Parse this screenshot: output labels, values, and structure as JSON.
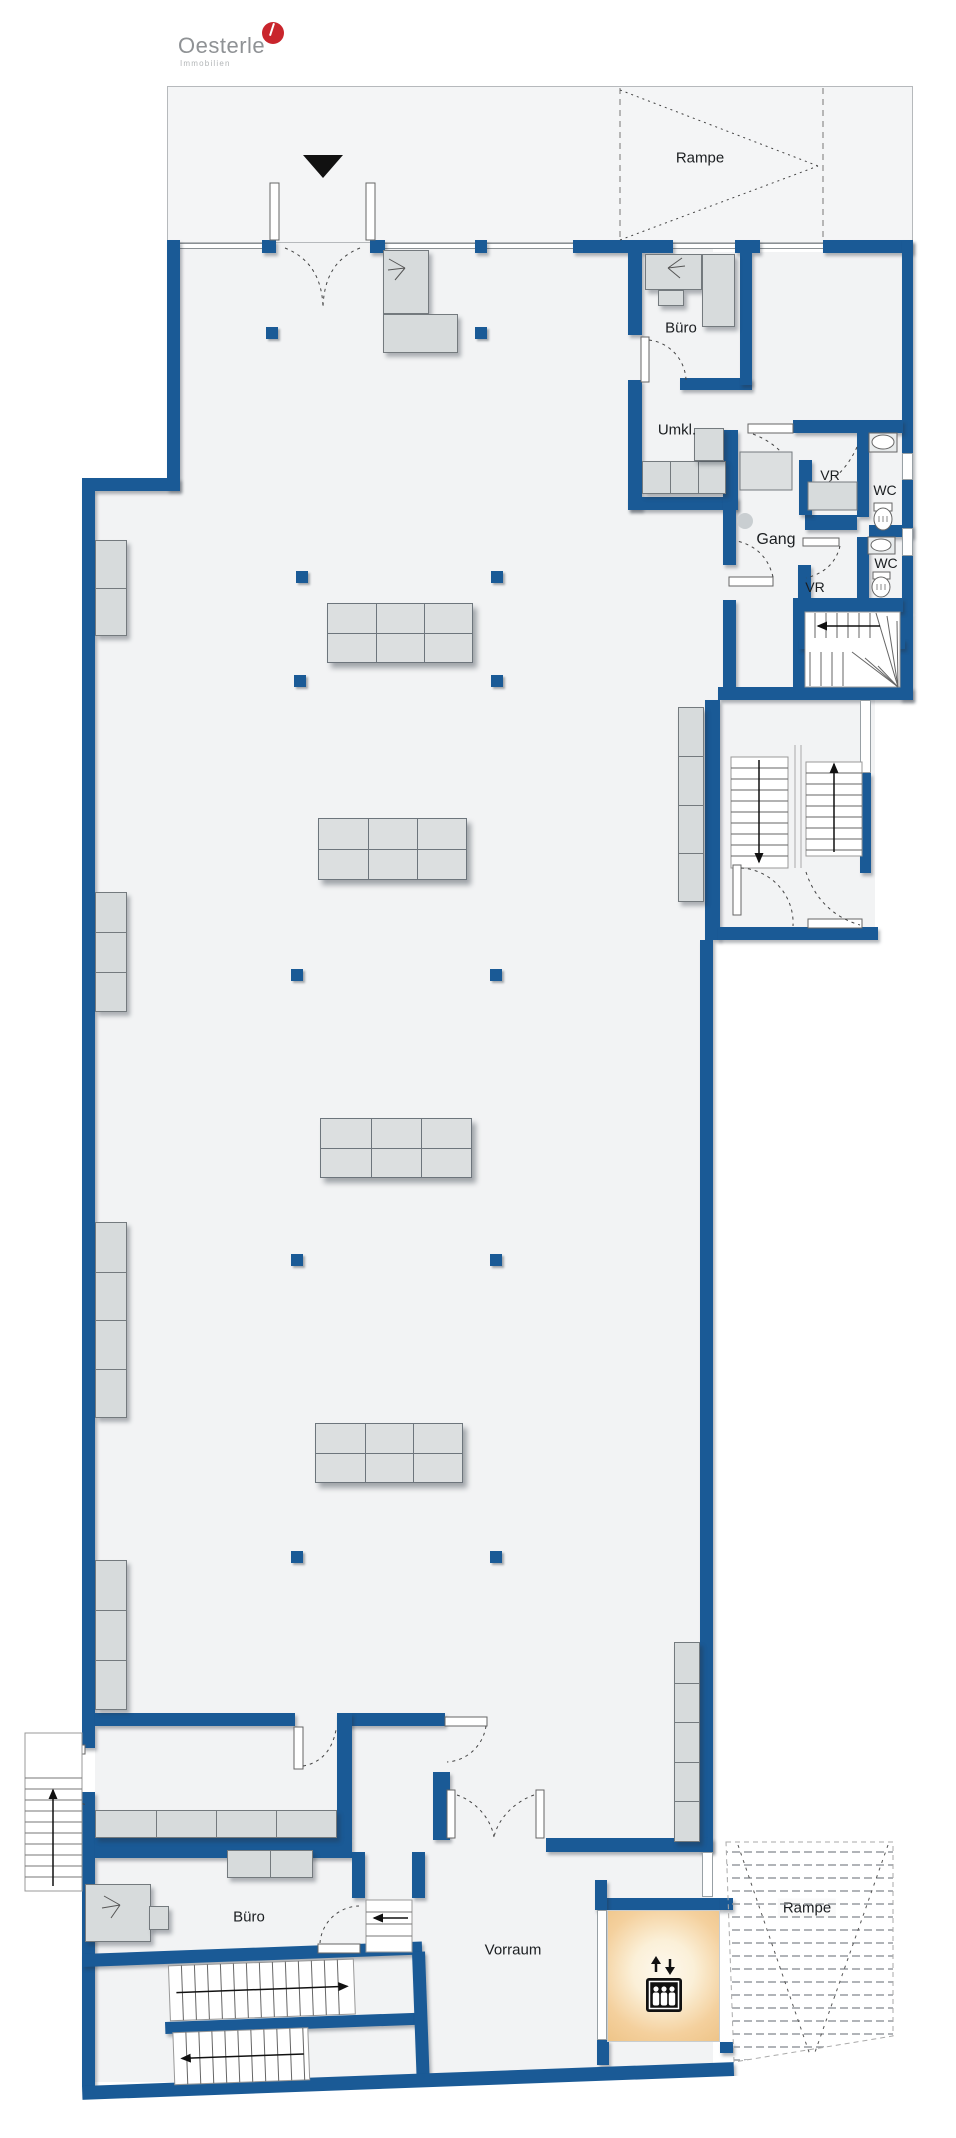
{
  "page": {
    "width": 956,
    "height": 2138,
    "background": "#ffffff"
  },
  "logo": {
    "brand": "Oesterle",
    "tagline": "Immobilien",
    "mark": "red-circle"
  },
  "plan": {
    "rooms": [
      {
        "id": "ramp_top",
        "label": "Rampe"
      },
      {
        "id": "buero_top",
        "label": "Büro"
      },
      {
        "id": "umkl",
        "label": "Umkl."
      },
      {
        "id": "vr_upper",
        "label": "VR"
      },
      {
        "id": "wc_upper",
        "label": "WC"
      },
      {
        "id": "gang",
        "label": "Gang"
      },
      {
        "id": "wc_lower",
        "label": "WC"
      },
      {
        "id": "vr_lower",
        "label": "VR"
      },
      {
        "id": "buero_bottom",
        "label": "Büro"
      },
      {
        "id": "vorraum",
        "label": "Vorraum"
      },
      {
        "id": "ramp_bottom",
        "label": "Rampe"
      }
    ],
    "colors": {
      "wall": "#1a5a96",
      "floor": "#f2f3f4",
      "furniture": "#d7dbdc",
      "elevator_highlight": "#eec488",
      "logo_red": "#c9252c"
    },
    "icons": [
      {
        "name": "entrance-arrow-icon",
        "meaning": "entrance direction marker"
      },
      {
        "name": "elevator-icon",
        "meaning": "elevator cabin with up/down arrows"
      },
      {
        "name": "toilet-icon",
        "meaning": "WC toilet fixture"
      },
      {
        "name": "washbasin-icon",
        "meaning": "WC washbasin fixture"
      },
      {
        "name": "stair-direction-arrow-icon",
        "meaning": "stair walk direction"
      }
    ]
  }
}
